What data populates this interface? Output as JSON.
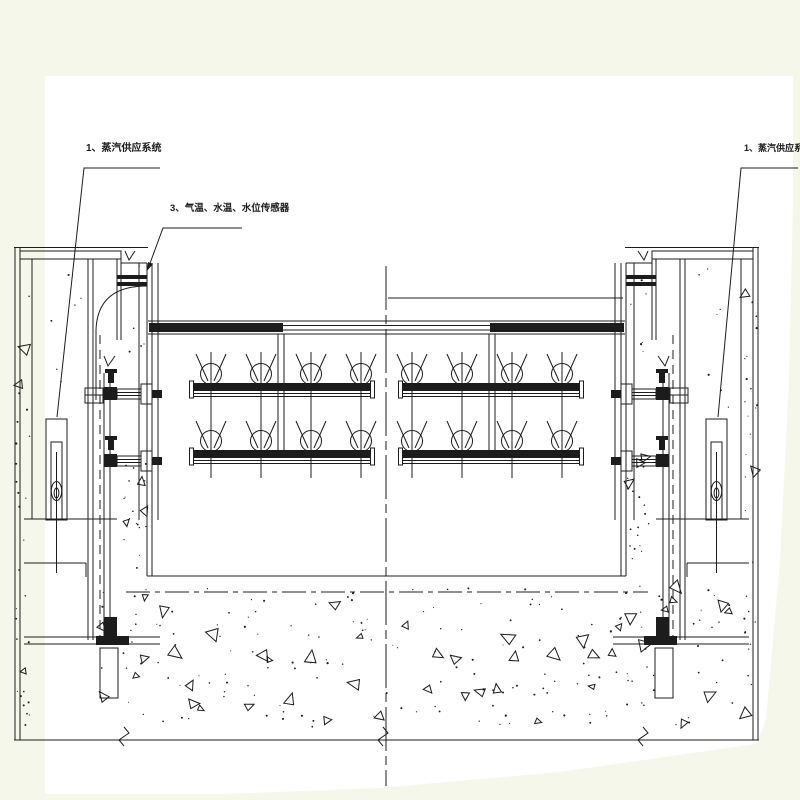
{
  "colors": {
    "background": "#f5f7eb",
    "sheet": "#ffffff",
    "ink": "#1c1c1c"
  },
  "labels": {
    "steam_supply_left": "1、蒸汽供应系统",
    "sensors": "3、气温、水温、水位传感器",
    "steam_supply_right": "1、蒸汽供应系统"
  }
}
